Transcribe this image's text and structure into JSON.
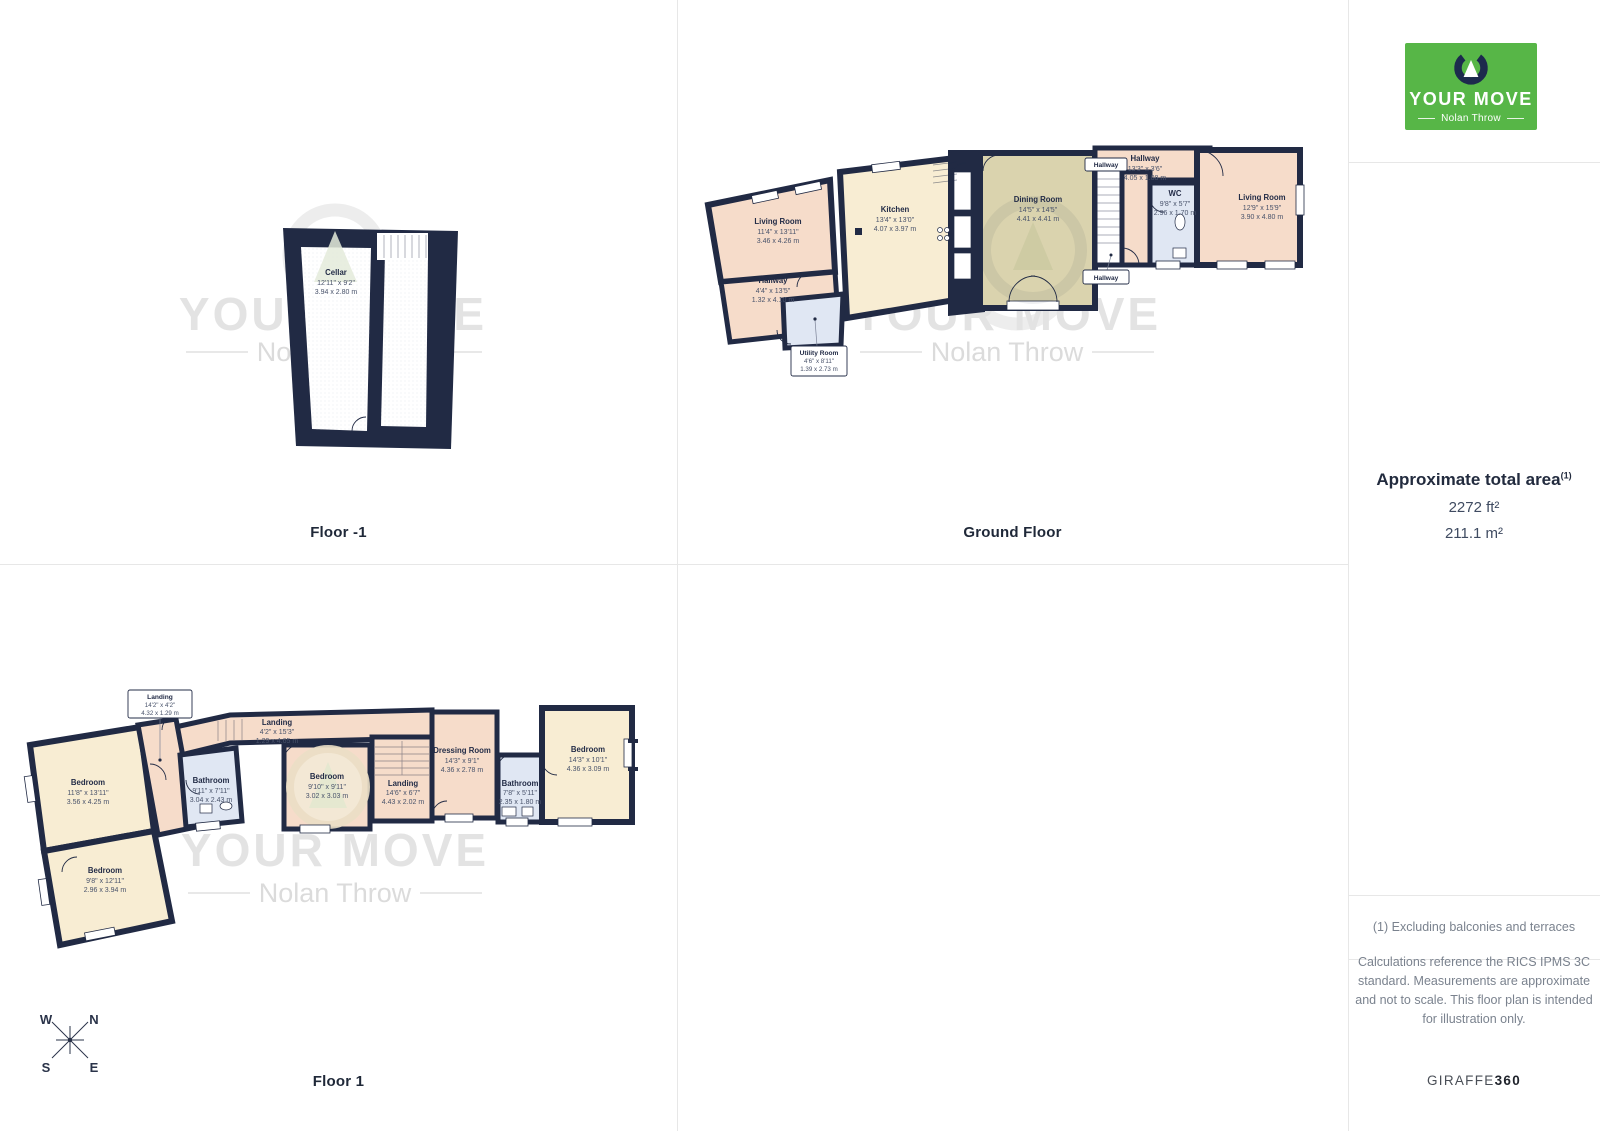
{
  "brand": {
    "name": "YOUR MOVE",
    "agency": "Nolan Throw"
  },
  "floors": {
    "minus1": {
      "label": "Floor -1",
      "cellar": {
        "name": "Cellar",
        "ft": "12'11\" x 9'2\"",
        "m": "3.94 x 2.80 m"
      }
    },
    "ground": {
      "label": "Ground Floor",
      "living_left": {
        "name": "Living Room",
        "ft": "11'4\" x 13'11\"",
        "m": "3.46 x 4.26 m"
      },
      "kitchen": {
        "name": "Kitchen",
        "ft": "13'4\" x 13'0\"",
        "m": "4.07 x 3.97 m"
      },
      "hallway_left": {
        "name": "Hallway",
        "ft": "4'4\" x 13'5\"",
        "m": "1.32 x 4.10 m"
      },
      "utility": {
        "name": "Utility Room",
        "ft": "4'6\" x 8'11\"",
        "m": "1.39 x 2.73 m"
      },
      "dining": {
        "name": "Dining Room",
        "ft": "14'5\" x 14'5\"",
        "m": "4.41 x 4.41 m"
      },
      "hallway_box": {
        "name": "Hallway"
      },
      "hallway_top": {
        "name": "Hallway",
        "ft": "13'3\" x 3'6\"",
        "m": "4.05 x 1.08 m"
      },
      "wc": {
        "name": "WC",
        "ft": "9'8\" x 5'7\"",
        "m": "2.96 x 1.70 m"
      },
      "living_right": {
        "name": "Living Room",
        "ft": "12'9\" x 15'9\"",
        "m": "3.90 x 4.80 m"
      },
      "hallway_callout": {
        "name": "Hallway"
      }
    },
    "first": {
      "label": "Floor 1",
      "landing_callout": {
        "name": "Landing",
        "ft": "14'2\" x 4'2\"",
        "m": "4.32 x 1.29 m"
      },
      "landing_top": {
        "name": "Landing",
        "ft": "4'2\" x 15'3\"",
        "m": "1.29 x 4.65 m"
      },
      "bedroom_top_left": {
        "name": "Bedroom",
        "ft": "11'8\" x 13'11\"",
        "m": "3.56 x 4.25 m"
      },
      "bathroom_left": {
        "name": "Bathroom",
        "ft": "9'11\" x 7'11\"",
        "m": "3.04 x 2.43 m"
      },
      "bedroom_bottom_left": {
        "name": "Bedroom",
        "ft": "9'8\" x 12'11\"",
        "m": "2.96 x 3.94 m"
      },
      "bedroom_middle": {
        "name": "Bedroom",
        "ft": "9'10\" x 9'11\"",
        "m": "3.02 x 3.03 m"
      },
      "landing_middle": {
        "name": "Landing",
        "ft": "14'6\" x 6'7\"",
        "m": "4.43 x 2.02 m"
      },
      "dressing": {
        "name": "Dressing Room",
        "ft": "14'3\" x 9'1\"",
        "m": "4.36 x 2.78 m"
      },
      "bathroom_right": {
        "name": "Bathroom",
        "ft": "7'8\" x 5'11\"",
        "m": "2.35 x 1.80 m"
      },
      "bedroom_right": {
        "name": "Bedroom",
        "ft": "14'3\" x 10'1\"",
        "m": "4.36 x 3.09 m"
      }
    }
  },
  "compass": {
    "n": "N",
    "e": "E",
    "s": "S",
    "w": "W"
  },
  "sidebar": {
    "area_title": "Approximate total area",
    "footnote_marker": "(1)",
    "area_ft": "2272 ft²",
    "area_m": "211.1 m²",
    "footnote": "(1) Excluding balconies and terraces",
    "disclaimer": "Calculations reference the RICS IPMS 3C standard. Measurements are approximate and not to scale. This floor plan is intended for illustration only.",
    "giraffe": "GIRAFFE",
    "giraffe_bold": "360"
  },
  "colors": {
    "brand_green": "#57B647",
    "logo_navy": "#1D2A4D",
    "wall_navy": "#212A44",
    "room_pink": "#F6DCCA",
    "room_cream": "#F8EDD3",
    "room_olive": "#DAD3AE",
    "room_blue": "#E0E7F3"
  }
}
